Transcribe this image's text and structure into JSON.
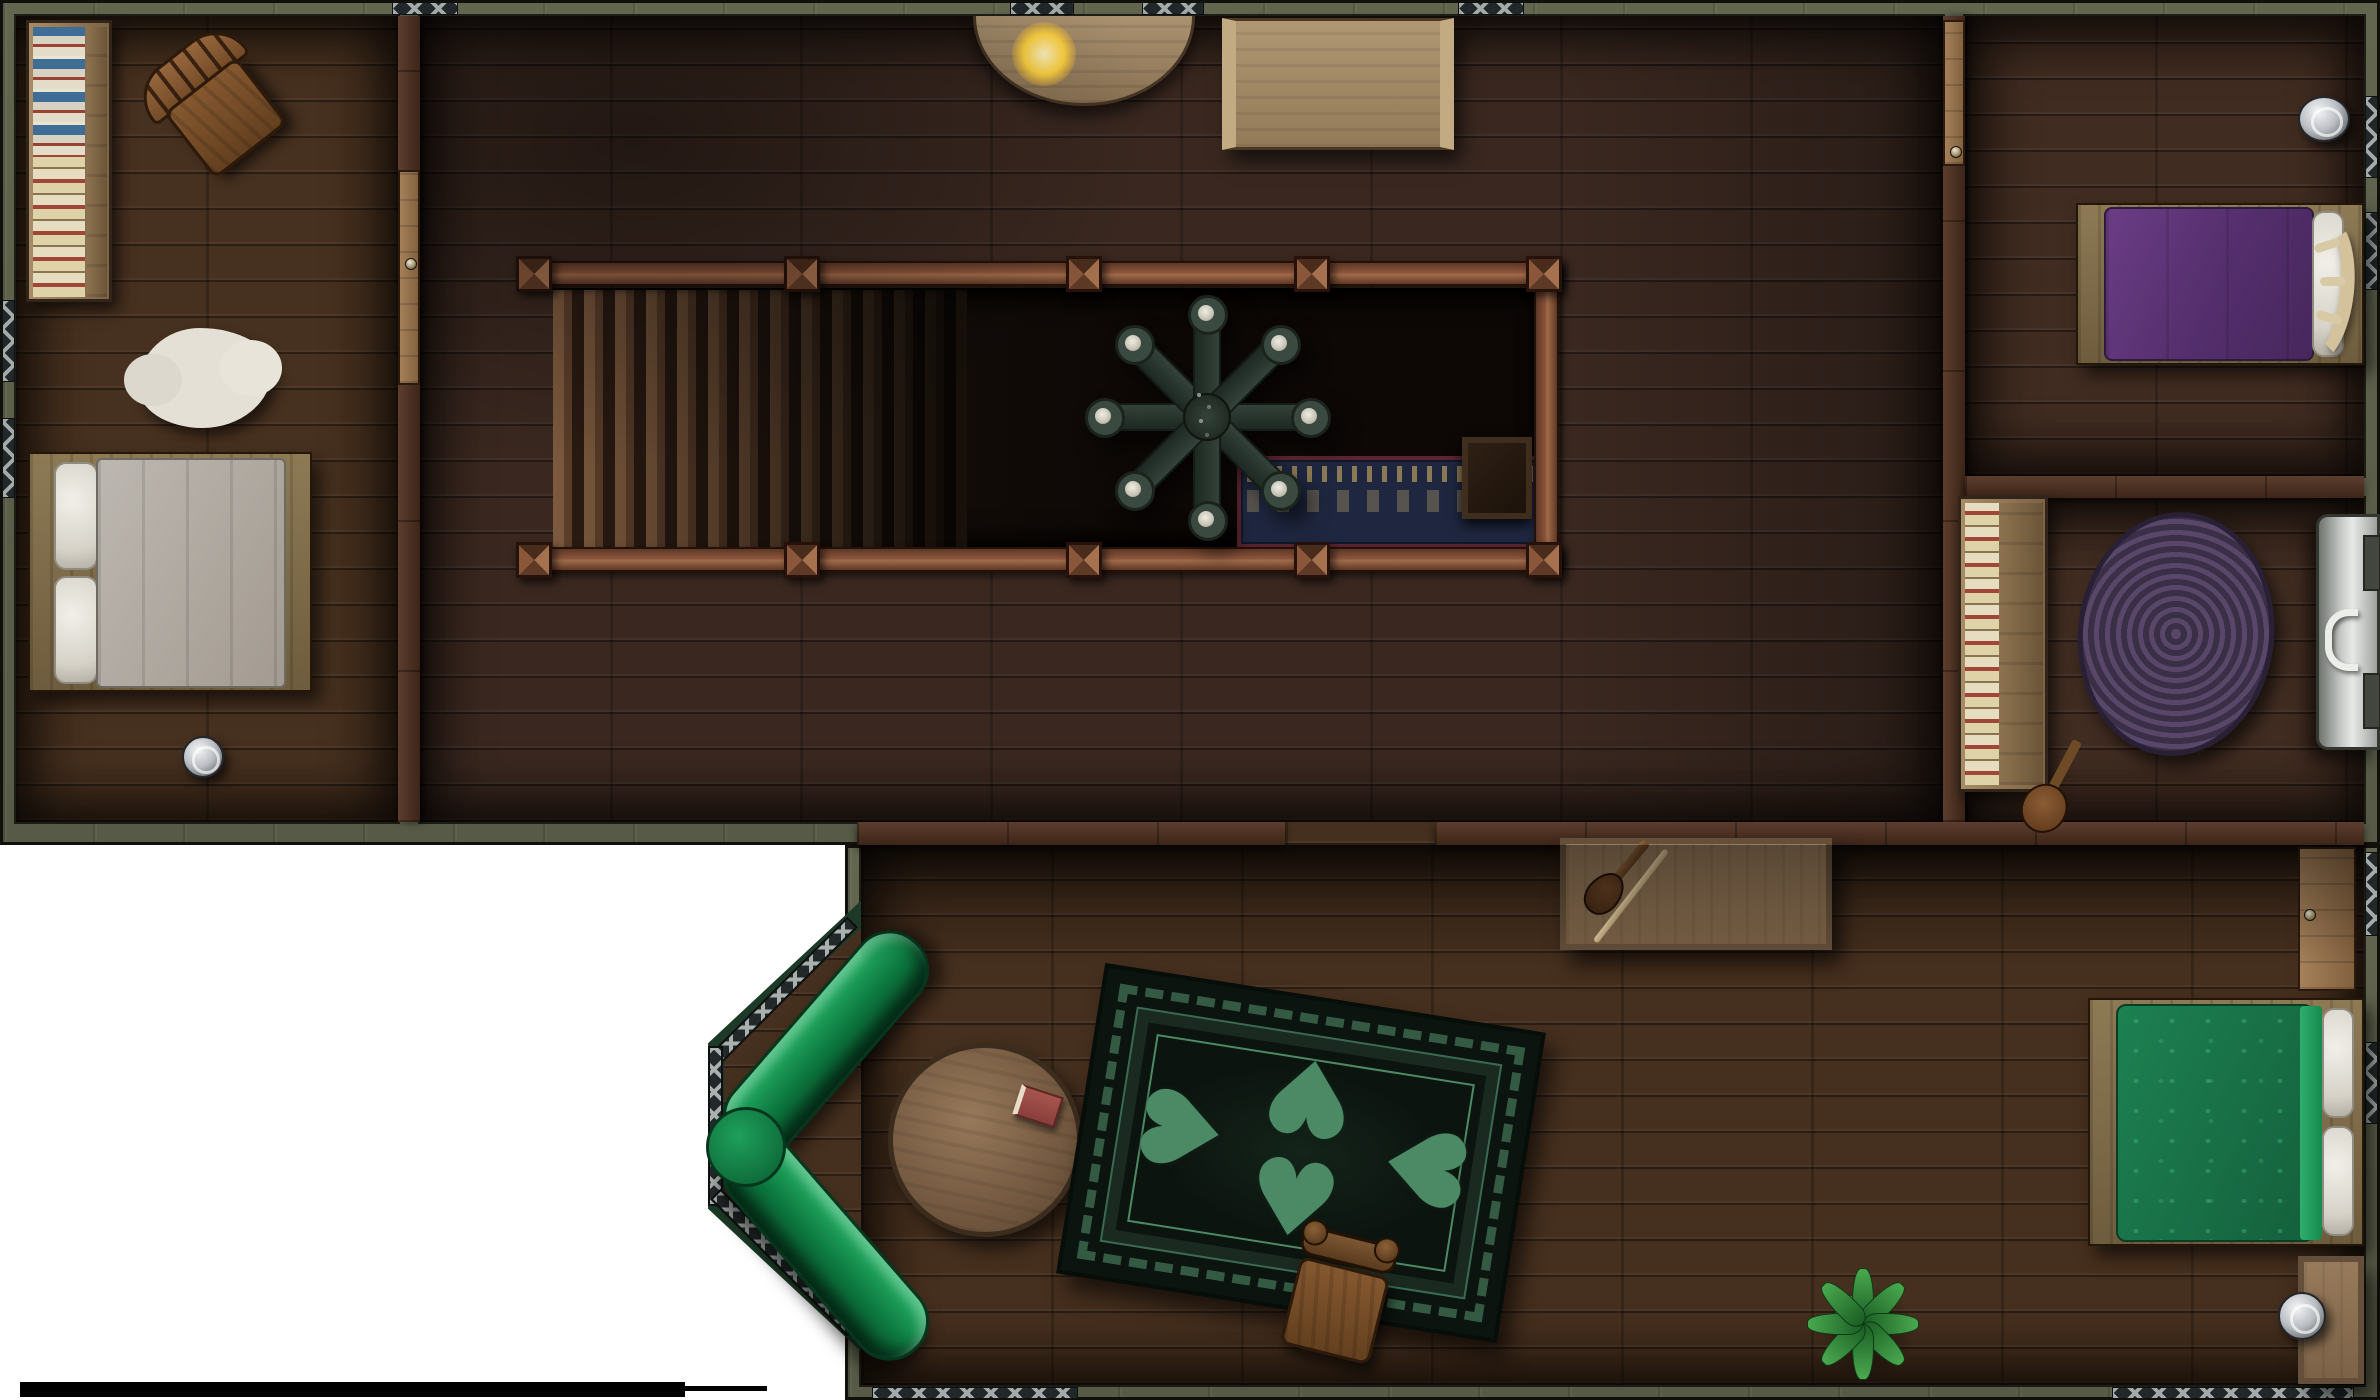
{
  "meta": {
    "kind": "top-down fantasy battle map (VTT asset)",
    "scene": "wooden tavern / inn upper floor interior",
    "canvas_px": {
      "width": 2380,
      "height": 1400
    },
    "page_background": "#ffffff",
    "visible_text": "none"
  },
  "motifs": {
    "rug_heart_glyph": "♥"
  },
  "palette": {
    "outer_wall": "#5d614e",
    "wall_outline": "#12100a",
    "interior_wall_wood": "#56382a",
    "floor_hall": "#3a2820",
    "floor_west_bedroom": "#46301f",
    "floor_east_rooms": "#402c21",
    "floor_common_room": "#452f1e",
    "stairwell_void": "#120c08",
    "window_glass": "#22282a",
    "window_frame": "#a3aaa7",
    "railing_wood": "#8a553c",
    "chandelier_iron": "#33423a",
    "candle_white": "#dcd9cc",
    "couch_green": "#0d7a40",
    "rug_green_dark": "#0c140f",
    "rug_green_pattern": "#4c8a66",
    "rug_oval_purple": "#4d3d55",
    "lower_rug_navy": "#1f2740",
    "bed_purple": "#5e3378",
    "bed_green": "#1d8152",
    "bed_white": "#b6b1a9",
    "fur_rug": "#e4e0d6",
    "metal_silver": "#c4c7c9",
    "outside_green": "#1c3a27",
    "scale_bar": "#000000"
  },
  "rooms": [
    {
      "id": "west-bedroom",
      "name": "west bedroom",
      "furniture": [
        "bookshelf with books",
        "wooden chair",
        "white fur rug",
        "double bed with white linens",
        "silver candlestick",
        "door to hall"
      ]
    },
    {
      "id": "main-hall",
      "name": "main hall with stairwell",
      "furniture": [
        "staircase going down",
        "railed stairwell opening",
        "8-arm iron candle chandelier",
        "half-round console table with lit candle",
        "light wood side table",
        "lower-floor rug seen through opening",
        "lower-floor crate seen through opening"
      ]
    },
    {
      "id": "northeast-bedroom",
      "name": "northeast bedroom",
      "furniture": [
        "double bed with purple blanket and antler headboard",
        "silver lantern",
        "door to hall"
      ]
    },
    {
      "id": "east-room",
      "name": "east sitting room",
      "furniture": [
        "bookshelf with books",
        "lute leaning at shelf",
        "oval braided purple rug",
        "metal stove on east wall",
        "open door to common room"
      ]
    },
    {
      "id": "south-common-room",
      "name": "south common room",
      "furniture": [
        "sideboard with violin and bow",
        "green corner couch in bay window nook",
        "round wooden table with red book",
        "large green ornamented rug",
        "wooden chair",
        "potted plant",
        "double bed with green patterned blanket",
        "nightstand",
        "silver candlestick",
        "doorway to hall"
      ]
    }
  ],
  "items": {
    "chandelier": "wrought-iron 8-candle chandelier hanging over stairwell",
    "staircase": "wooden staircase descending to lower floor",
    "couch": "green corner couch in bay window nook",
    "big_rug": "large black and green ornamented rug",
    "white_bed": "double bed with white linens",
    "purple_bed": "double bed with purple blanket and antler headboard",
    "green_bed": "double bed with green patterned blanket",
    "violin": "violin and bow on sideboard",
    "lute": "lute leaning against bookshelf",
    "stove": "metal stove on east wall",
    "plant": "potted plant",
    "scale_bar": "map scale bar"
  },
  "counts": {
    "beds": 3,
    "bookshelves": 2,
    "rugs_visible": 4,
    "chandelier_candles": 8,
    "doors": 4,
    "bay_window_segments": 3
  }
}
